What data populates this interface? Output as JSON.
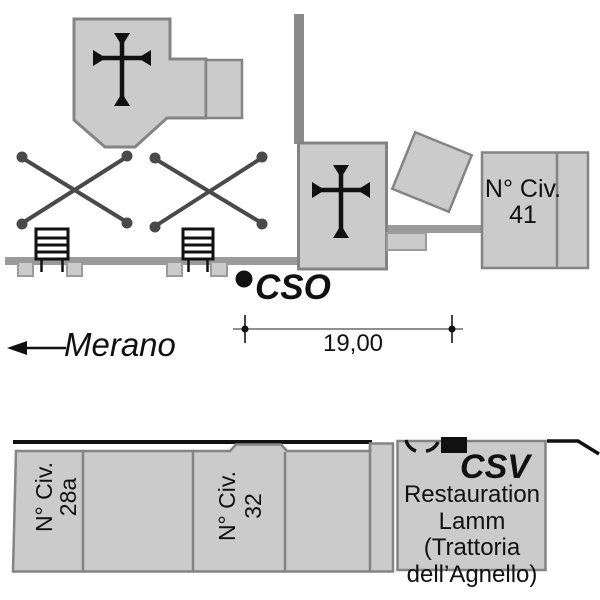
{
  "title": "Survey point location sketch (monografia)",
  "colors": {
    "paper": "#ffffff",
    "ink": "#111111",
    "building_fill": "#cbcbcb",
    "building_outline": "#848484",
    "road_gray": "#9b9b9b",
    "bar_gray": "#8a8a8a",
    "dim_gray": "#8f8f8f",
    "x_gray": "#4a4a4a"
  },
  "points": {
    "cso": {
      "label": "CSO"
    },
    "csv": {
      "label": "CSV"
    }
  },
  "direction": {
    "label": "Merano"
  },
  "dimension": {
    "value": "19,00"
  },
  "buildings": {
    "civ41": {
      "line1": "N° Civ.",
      "line2": "41"
    },
    "civ28a": {
      "line1": "N° Civ.",
      "line2": "28a"
    },
    "civ32": {
      "line1": "N° Civ.",
      "line2": "32"
    },
    "restaurant": {
      "line1": "Restauration",
      "line2": "Lamm",
      "line3": "(Trattoria",
      "line4": "dell’Agnello)"
    }
  },
  "symbols": [
    "church-cross-icon",
    "chapel-cross-icon",
    "crossed-lines-field-icon",
    "stairs-icon",
    "fence-post-icon",
    "survey-point-dot-icon",
    "west-arrow-icon",
    "arch-doorway-icon",
    "csv-wall-marker-icon"
  ]
}
